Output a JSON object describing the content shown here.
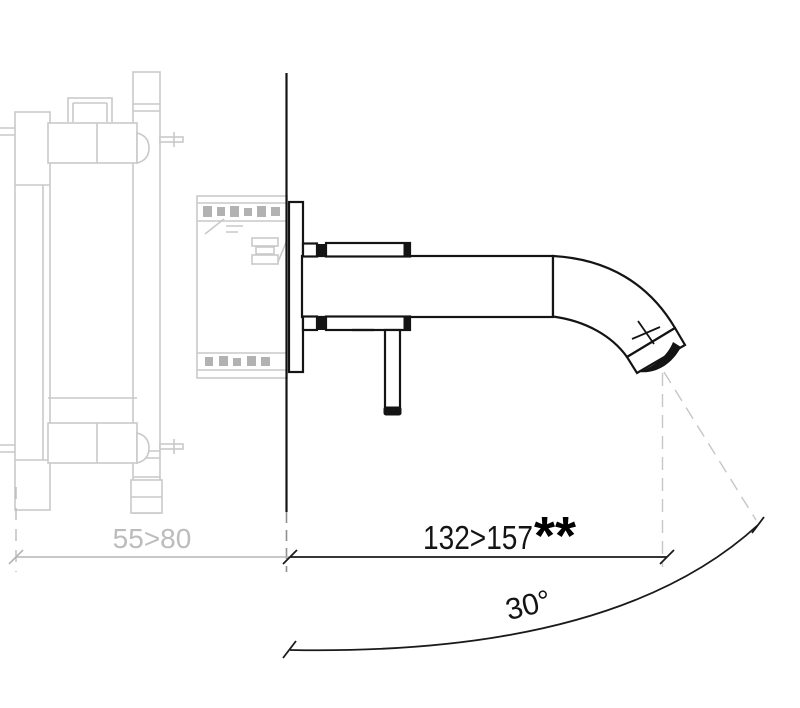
{
  "diagram": {
    "title": "Wall-mounted single-lever basin mixer – side installation drawing",
    "type": "technical-line-drawing",
    "labels": {
      "wall_depth": "55>80",
      "spout_reach": "132>157",
      "spout_reach_marker": "**",
      "spout_angle": "30°"
    },
    "dimensions": [
      {
        "name": "concealed-body-depth",
        "value": "55>80",
        "unit": "mm",
        "style": "gray"
      },
      {
        "name": "spout-projection",
        "value": "132>157",
        "unit": "mm",
        "footnote": "**",
        "style": "black"
      },
      {
        "name": "water-stream-angle",
        "value": "30°",
        "style": "black"
      }
    ],
    "colors": {
      "foreground": "#141414",
      "concealed_body": "#c9c9c9",
      "dimension_gray": "#b5b5b5",
      "background": "#ffffff"
    }
  }
}
